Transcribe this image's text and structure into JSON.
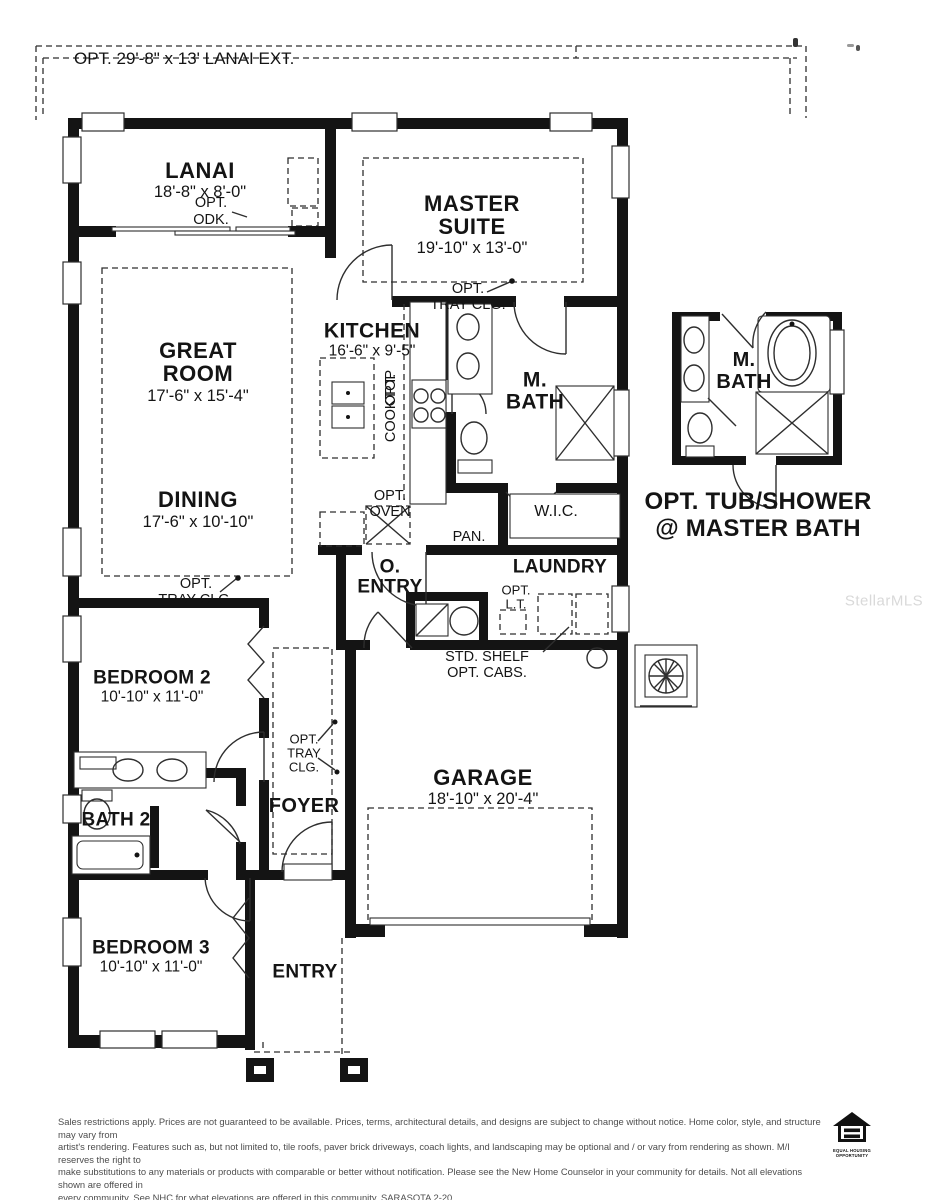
{
  "watermark": "StellarMLS",
  "plan": {
    "opt_lanai_ext": "OPT. 29'-8\" x 13' LANAI EXT.",
    "lanai": {
      "name": "LANAI",
      "dims": "18'-8\" x 8'-0\""
    },
    "opt_odk": {
      "l1": "OPT.",
      "l2": "ODK."
    },
    "master": {
      "l1": "MASTER",
      "l2": "SUITE",
      "dims": "19'-10\" x 13'-0\""
    },
    "master_tray": {
      "l1": "OPT.",
      "l2": "TRAY CLG."
    },
    "great": {
      "l1": "GREAT",
      "l2": "ROOM",
      "dims": "17'-6\" x 15'-4\""
    },
    "kitchen": {
      "name": "KITCHEN",
      "dims": "16'-6\" x 9'-5\""
    },
    "opt_cooktop": {
      "l1": "OPT.",
      "l2": "COOKTOP"
    },
    "mbath": {
      "l1": "M.",
      "l2": "BATH"
    },
    "dining": {
      "name": "DINING",
      "dims": "17'-6\" x 10'-10\""
    },
    "opt_oven": {
      "l1": "OPT.",
      "l2": "OVEN"
    },
    "pan": "PAN.",
    "wic": "W.I.C.",
    "great_tray": {
      "l1": "OPT.",
      "l2": "TRAY CLG."
    },
    "o_entry": {
      "l1": "O.",
      "l2": "ENTRY"
    },
    "laundry": "LAUNDRY",
    "opt_lt": {
      "l1": "OPT.",
      "l2": "L.T."
    },
    "std_shelf": {
      "l1": "STD. SHELF",
      "l2": "OPT. CABS."
    },
    "bedroom2": {
      "name": "BEDROOM 2",
      "dims": "10'-10\" x 11'-0\""
    },
    "foyer_tray": {
      "l1": "OPT.",
      "l2": "TRAY",
      "l3": "CLG."
    },
    "bath2": "BATH 2",
    "foyer": "FOYER",
    "garage": {
      "name": "GARAGE",
      "dims": "18'-10\" x 20'-4\""
    },
    "bedroom3": {
      "name": "BEDROOM 3",
      "dims": "10'-10\" x 11'-0\""
    },
    "entry": "ENTRY",
    "mbath_detail": {
      "l1": "M.",
      "l2": "BATH"
    },
    "opt_tub_caption": {
      "l1": "OPT. TUB/SHOWER",
      "l2": "@ MASTER BATH"
    }
  },
  "footer": {
    "disclaimer_lines": [
      "Sales restrictions apply. Prices are not guaranteed to be available. Prices, terms, architectural details, and designs are subject to change without notice. Home color, style, and structure may vary from",
      "artist's rendering. Features such as, but not limited to, tile roofs, paver brick driveways, coach lights, and landscaping may be optional and / or vary from rendering as shown. M/I reserves the right to",
      "make substitutions to any materials or products with comparable or better without notification. Please see the New Home Counselor in your community for details. Not all elevations shown are offered in",
      "every community. See NHC for what elevations are offered in this community. SARASOTA 2-20"
    ],
    "equal_housing": {
      "l1": "EQUAL HOUSING",
      "l2": "OPPORTUNITY"
    }
  }
}
